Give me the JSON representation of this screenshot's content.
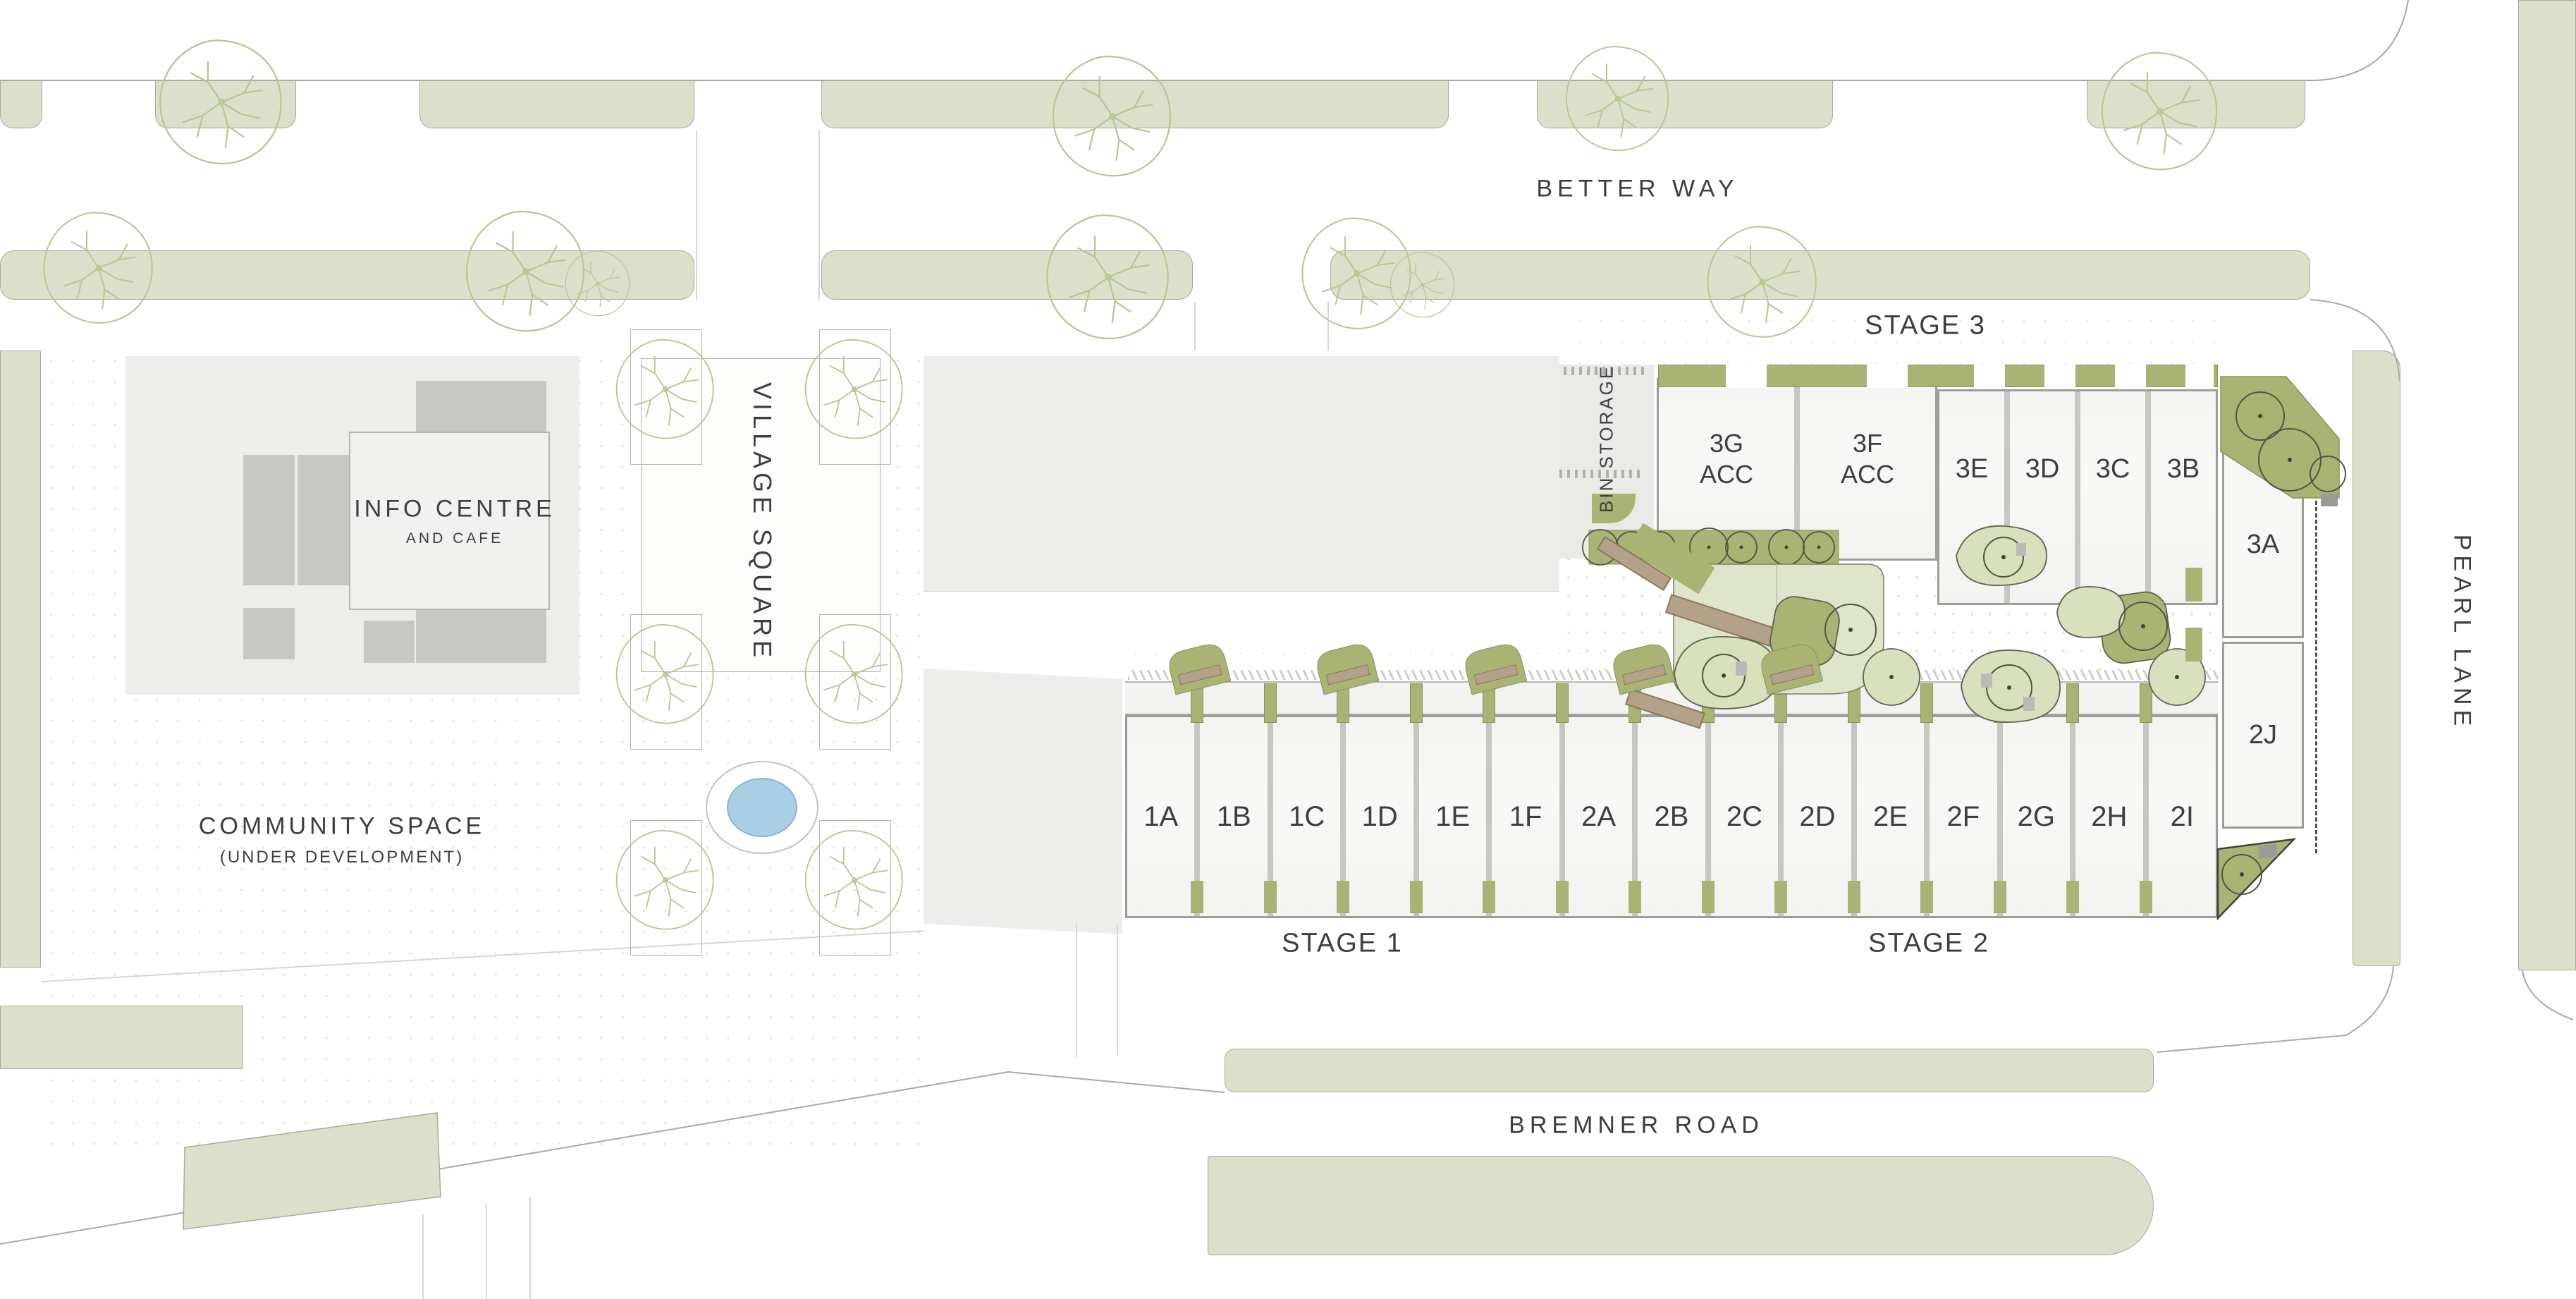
{
  "map": {
    "streets": {
      "better_way": "BETTER WAY",
      "pearl_lane": "PEARL LANE",
      "bremner_road": "BREMNER ROAD"
    },
    "stages": {
      "s1": "STAGE 1",
      "s2": "STAGE 2",
      "s3": "STAGE 3"
    },
    "areas": {
      "info_centre_title": "INFO CENTRE",
      "info_centre_sub": "AND CAFE",
      "community_title": "COMMUNITY SPACE",
      "community_sub": "(UNDER DEVELOPMENT)",
      "village_square": "VILLAGE SQUARE",
      "bin_storage": "BIN STORAGE"
    },
    "lots": {
      "stage12_row": [
        "1A",
        "1B",
        "1C",
        "1D",
        "1E",
        "1F",
        "2A",
        "2B",
        "2C",
        "2D",
        "2E",
        "2F",
        "2G",
        "2H",
        "2I"
      ],
      "stage3_acc": [
        {
          "id": "3G",
          "tag": "ACC"
        },
        {
          "id": "3F",
          "tag": "ACC"
        }
      ],
      "stage3_row": [
        "3E",
        "3D",
        "3C",
        "3B"
      ],
      "east_column": [
        "3A",
        "2J"
      ]
    },
    "colors": {
      "verge": "#dce0cb",
      "olive": "#a9b474",
      "leaf": "#d8e0bd",
      "pond": "#a9cfe5",
      "ink": "#3c3f3e",
      "panel": "#ededeb",
      "bench": "#b3a189"
    }
  }
}
